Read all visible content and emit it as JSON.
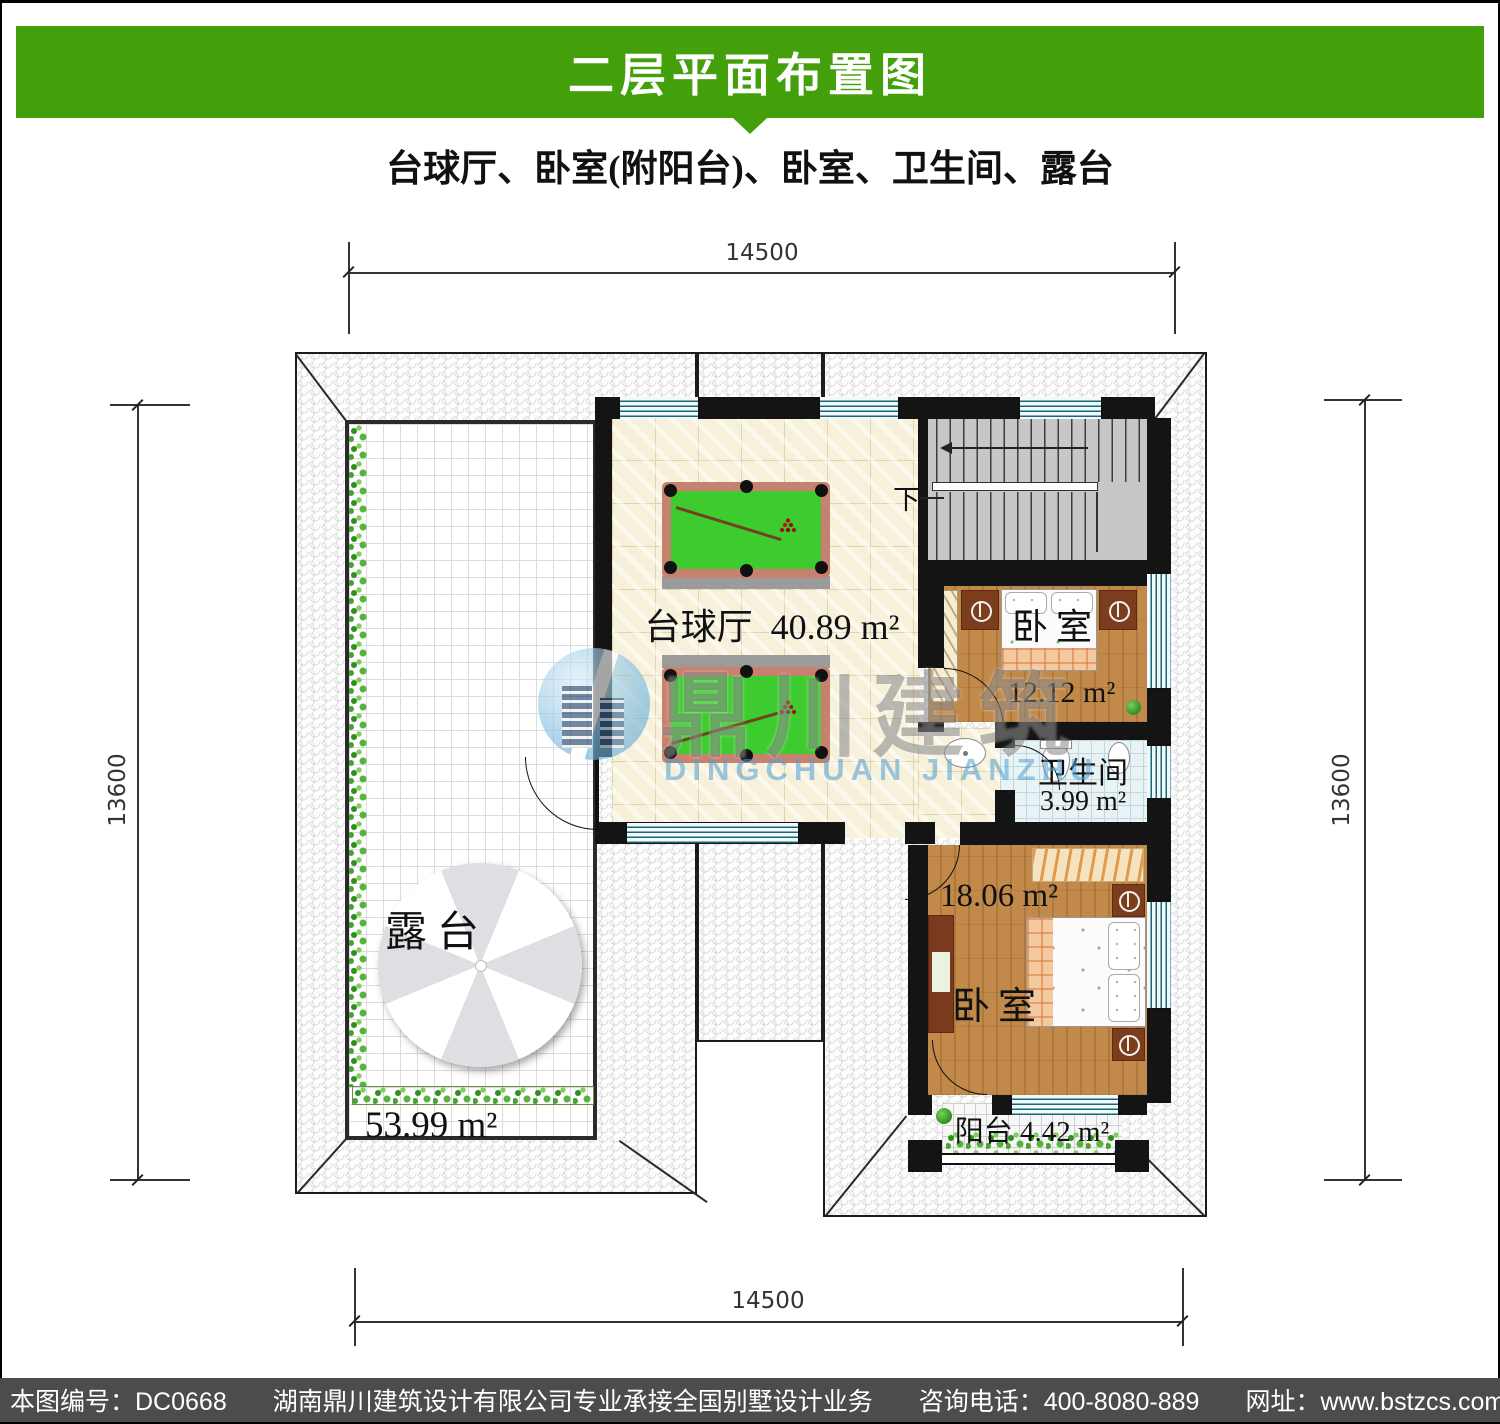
{
  "header": {
    "title": "二层平面布置图",
    "subtitle": "台球厅、卧室(附阳台)、卧室、卫生间、露台"
  },
  "dimensions": {
    "top": "14500",
    "bottom": "14500",
    "left": "13600",
    "right": "13600"
  },
  "rooms": {
    "terrace": {
      "name": "露台",
      "area": "53.99 m²"
    },
    "billiard": {
      "name": "台球厅",
      "area": "40.89 m²"
    },
    "bedroom1": {
      "name": "卧室",
      "area": "12.12 m²"
    },
    "bathroom": {
      "name": "卫生间",
      "area": "3.99 m²"
    },
    "bedroom2": {
      "name": "卧室",
      "area": "18.06 m²"
    },
    "balcony": {
      "name": "阳台",
      "area": "4.42 m²"
    },
    "stairs": {
      "down_label": "下"
    }
  },
  "watermark": {
    "cn": "鼎川建筑",
    "en": "DINGCHUAN JIANZHU"
  },
  "footer": {
    "drawing_no": "本图编号：DC0668",
    "company": "湖南鼎川建筑设计有限公司专业承接全国别墅设计业务",
    "phone": "咨询电话：400-8080-889",
    "website": "网址：www.bstzcs.com"
  },
  "colors": {
    "banner_green": "#43a00b",
    "footer_gray": "#4c4c4c",
    "felt_green": "#3ecb30",
    "table_rail": "#c8806f",
    "wood_floor": "#c18a4b",
    "bath_tile": "#e9f3f5",
    "hall_floor": "#f7f0da",
    "window_teal": "#1c6575"
  }
}
